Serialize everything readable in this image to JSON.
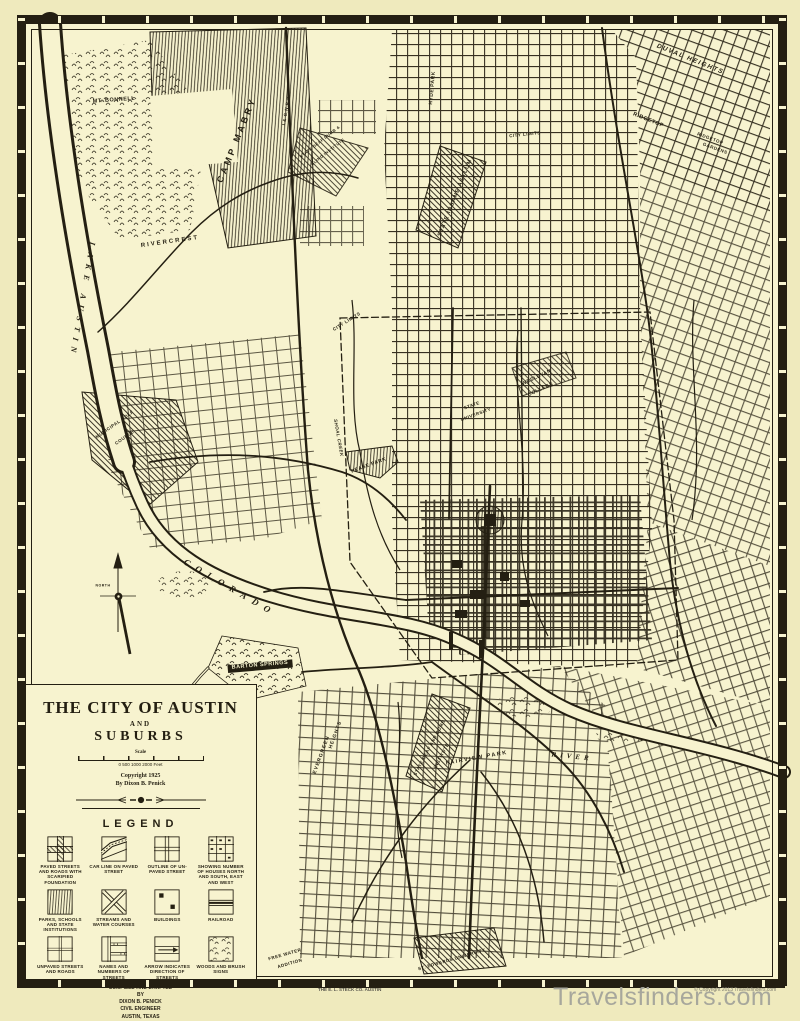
{
  "page": {
    "paper_color": "#f7f3cf",
    "margin_color": "#efeabd",
    "ink_color": "#241f12",
    "watermark_color": "#a7a79c"
  },
  "title_block": {
    "title": "THE CITY OF AUSTIN",
    "and_word": "AND",
    "subtitle": "SUBURBS",
    "scale_word": "Scale",
    "scale_numbers": "0      500     1000                 2000 Feet",
    "copyright_line": "Copyright 1925",
    "byline": "By Dixon B. Penick"
  },
  "legend": {
    "heading": "LEGEND",
    "items": [
      {
        "caption": "PAVED STREETS AND ROADS WITH SCARIFIED FOUNDATION"
      },
      {
        "caption": "CAR LINE ON PAVED STREET"
      },
      {
        "caption": "OUTLINE OF UN-PAVED STREET"
      },
      {
        "caption": "SHOWING NUMBER OF HOUSES NORTH AND SOUTH, EAST AND WEST"
      },
      {
        "caption": "PARKS, SCHOOLS AND STATE INSTITUTIONS"
      },
      {
        "caption": "STREAMS AND WATER COURSES"
      },
      {
        "caption": "BUILDINGS"
      },
      {
        "caption": "RAILROAD"
      },
      {
        "caption": "UNPAVED STREETS AND ROADS"
      },
      {
        "caption": "NAMES AND NUMBERS OF STREETS"
      },
      {
        "caption": "ARROW INDICATES DIRECTION OF STREETS"
      },
      {
        "caption": "WOODS AND BRUSH SIGNS"
      }
    ]
  },
  "credits": {
    "line1": "COMPILED AND DRAFTED",
    "line2": "BY",
    "line3": "DIXON B. PENICK",
    "line4": "CIVIL ENGINEER",
    "line5": "AUSTIN, TEXAS"
  },
  "compass": {
    "north_label": "NORTH"
  },
  "footer": {
    "printer_mark": "THE E. L. STECK CO. AUSTIN",
    "copyright_small": "© Copyright 2013 Travelsfinders.com",
    "watermark": "Travelsfinders.com"
  },
  "map_labels": [
    {
      "text": "MT. BONNELL",
      "x": 114,
      "y": 101,
      "rot": -4,
      "size": 5.5,
      "ls": 0.5
    },
    {
      "text": "CAMP MABRY",
      "x": 237,
      "y": 140,
      "rot": -68,
      "size": 9,
      "ls": 3
    },
    {
      "text": "RIVERCREST",
      "x": 170,
      "y": 242,
      "rot": -8,
      "size": 6,
      "ls": 2
    },
    {
      "text": "LAKE AUSTIN",
      "x": 82,
      "y": 300,
      "rot": 100,
      "size": 8,
      "ls": 6,
      "cls": "serif"
    },
    {
      "text": "COLORADO",
      "x": 230,
      "y": 588,
      "rot": 30,
      "size": 9,
      "ls": 7,
      "cls": "serif"
    },
    {
      "text": "RIVER",
      "x": 572,
      "y": 757,
      "rot": 6,
      "size": 7,
      "ls": 4,
      "cls": "serif"
    },
    {
      "text": "DUVAL HEIGHTS",
      "x": 690,
      "y": 60,
      "rot": 22,
      "size": 6.5,
      "ls": 1.5,
      "cls": "ital"
    },
    {
      "text": "RIDGETOP",
      "x": 648,
      "y": 121,
      "rot": 22,
      "size": 5.5,
      "ls": 0.5
    },
    {
      "text": "RIDGETOP",
      "x": 710,
      "y": 139,
      "rot": 20,
      "size": 4.5
    },
    {
      "text": "GARDENS",
      "x": 715,
      "y": 149,
      "rot": 20,
      "size": 4.5
    },
    {
      "text": "I.& G.N.R.R.",
      "x": 287,
      "y": 110,
      "rot": -80,
      "size": 4.5
    },
    {
      "text": "STATE DEAF DUMB &",
      "x": 320,
      "y": 142,
      "rot": -38,
      "size": 4
    },
    {
      "text": "BLIND INSTITUTE",
      "x": 328,
      "y": 152,
      "rot": -38,
      "size": 4
    },
    {
      "text": "CITY LIMITS",
      "x": 525,
      "y": 135,
      "rot": -6,
      "size": 4.5
    },
    {
      "text": "HYDE PARK",
      "x": 433,
      "y": 88,
      "rot": -85,
      "size": 5
    },
    {
      "text": "STATE INSANE ASYLUM",
      "x": 456,
      "y": 198,
      "rot": -68,
      "size": 5.5,
      "ls": 1
    },
    {
      "text": "CITY LIMITS",
      "x": 347,
      "y": 322,
      "rot": -32,
      "size": 4.5
    },
    {
      "text": "WESLEYAN",
      "x": 537,
      "y": 378,
      "rot": -25,
      "size": 5
    },
    {
      "text": "COLLEGE",
      "x": 541,
      "y": 390,
      "rot": -25,
      "size": 5
    },
    {
      "text": "STATE",
      "x": 472,
      "y": 406,
      "rot": -20,
      "size": 4.5
    },
    {
      "text": "UNIVERSITY",
      "x": 476,
      "y": 415,
      "rot": -20,
      "size": 4.5
    },
    {
      "text": "PEASE PARK",
      "x": 369,
      "y": 466,
      "rot": -20,
      "size": 5
    },
    {
      "text": "SHOAL CREEK",
      "x": 338,
      "y": 438,
      "rot": 80,
      "size": 4.5,
      "cls": "ital"
    },
    {
      "text": "MUNICIPAL GOLF",
      "x": 115,
      "y": 425,
      "rot": -35,
      "size": 4.5
    },
    {
      "text": "COURSE",
      "x": 125,
      "y": 438,
      "rot": -35,
      "size": 4.5
    },
    {
      "text": "NORTH",
      "x": 103,
      "y": 586,
      "rot": 0,
      "size": 3.5,
      "ls": 0.5
    },
    {
      "text": "BARTON SPRINGS",
      "x": 260,
      "y": 666,
      "rot": -5,
      "size": 5.5,
      "color": "#f7f3cf",
      "bg": "#241f12"
    },
    {
      "text": "EVERGREEN",
      "x": 322,
      "y": 755,
      "rot": -70,
      "size": 5,
      "ls": 1
    },
    {
      "text": "HEIGHTS",
      "x": 336,
      "y": 735,
      "rot": -70,
      "size": 5,
      "ls": 1
    },
    {
      "text": "STATE DEAF AND DUMB",
      "x": 430,
      "y": 748,
      "rot": -62,
      "size": 4.5
    },
    {
      "text": "INSTITUTE",
      "x": 442,
      "y": 756,
      "rot": -62,
      "size": 4.5
    },
    {
      "text": "FAIRVIEW PARK",
      "x": 477,
      "y": 759,
      "rot": -10,
      "size": 5.5,
      "ls": 1.5
    },
    {
      "text": "ST. EDWARDS UNIVERSITY",
      "x": 452,
      "y": 960,
      "rot": -16,
      "size": 4.5
    },
    {
      "text": "FREE WATER",
      "x": 285,
      "y": 955,
      "rot": -16,
      "size": 4.5
    },
    {
      "text": "ADDITION",
      "x": 290,
      "y": 964,
      "rot": -16,
      "size": 4.5
    }
  ]
}
